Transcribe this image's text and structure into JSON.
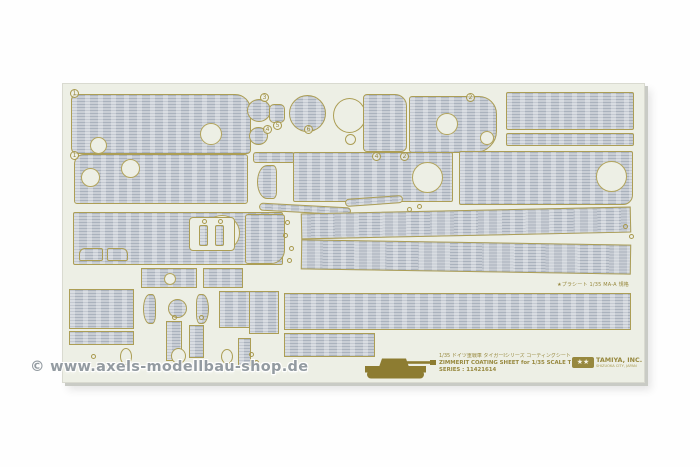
{
  "photo": {
    "background": "#fefefe"
  },
  "colors": {
    "sheet_cream": "#edefe5",
    "zimmerit_fill": "#c2c8cf",
    "zimmerit_rib": "#aab2bd",
    "outline_gold": "#ac9e55",
    "print_gold": "#97883e",
    "watermark_gray": "#8f979e"
  },
  "watermark": {
    "text": "© www.axels-modellbau-shop.de"
  },
  "footer": {
    "jp_line": "1/35 ドイツ重戦車 タイガーⅠシリーズ コーティングシートセット",
    "en_line": "ZIMMERIT COATING SHEET for 1/35 SCALE TIGER I",
    "series_line": "SERIES : 11421614",
    "tiny_note": "★プラシート 1/35 MA-A 規格"
  },
  "logo": {
    "stars": "★★",
    "name": "TAMIYA, INC.",
    "sub": "SHIZUOKA CITY, JAPAN"
  },
  "sheet": {
    "markers": [
      {
        "label": "1",
        "x": 7,
        "y": 5
      },
      {
        "label": "3",
        "x": 197,
        "y": 9
      },
      {
        "label": "4",
        "x": 200,
        "y": 41
      },
      {
        "label": "5",
        "x": 210,
        "y": 37
      },
      {
        "label": "6",
        "x": 241,
        "y": 41
      },
      {
        "label": "2",
        "x": 403,
        "y": 9
      },
      {
        "label": "1",
        "x": 7,
        "y": 67
      },
      {
        "label": "4",
        "x": 309,
        "y": 68
      },
      {
        "label": "2",
        "x": 337,
        "y": 68
      }
    ],
    "dots": [
      [
        222,
        136
      ],
      [
        220,
        149
      ],
      [
        226,
        162
      ],
      [
        224,
        174
      ],
      [
        560,
        140
      ],
      [
        566,
        150
      ],
      [
        28,
        270
      ],
      [
        34,
        278
      ],
      [
        139,
        135
      ],
      [
        155,
        135
      ],
      [
        186,
        268
      ],
      [
        191,
        276
      ],
      [
        109,
        231
      ],
      [
        136,
        231
      ],
      [
        344,
        123
      ],
      [
        354,
        120
      ]
    ],
    "pieces": [
      {
        "t": "p",
        "name": "panel-fender-top-left",
        "x": 8,
        "y": 10,
        "w": 180,
        "h": 60,
        "r": "6px 16px 4px 6px",
        "holes": [
          [
            18,
            42,
            17
          ],
          [
            128,
            28,
            22
          ]
        ]
      },
      {
        "t": "p",
        "name": "disc-small-a",
        "x": 184,
        "y": 15,
        "w": 24,
        "h": 23,
        "r": "50%"
      },
      {
        "t": "p",
        "name": "disc-small-b",
        "x": 186,
        "y": 43,
        "w": 19,
        "h": 18,
        "r": "50%"
      },
      {
        "t": "p",
        "name": "hatch-small",
        "x": 206,
        "y": 20,
        "w": 16,
        "h": 19,
        "r": "5px"
      },
      {
        "t": "p",
        "name": "disc-large",
        "x": 226,
        "y": 11,
        "w": 37,
        "h": 37,
        "r": "50%"
      },
      {
        "t": "o",
        "name": "ring-template",
        "x": 270,
        "y": 14,
        "w": 33,
        "h": 35,
        "r": "50%"
      },
      {
        "t": "o",
        "name": "ring-template-small",
        "x": 282,
        "y": 50,
        "w": 11,
        "h": 11,
        "r": "50%"
      },
      {
        "t": "p",
        "name": "panel-top-mid",
        "x": 300,
        "y": 10,
        "w": 44,
        "h": 58,
        "r": "4px 12px 6px 4px"
      },
      {
        "t": "p",
        "name": "panel-top-holes",
        "x": 346,
        "y": 12,
        "w": 88,
        "h": 57,
        "r": "3px 18px 22px 3px",
        "holes": [
          [
            26,
            16,
            22
          ],
          [
            70,
            34,
            14
          ]
        ]
      },
      {
        "t": "p",
        "name": "panel-top-right-wide",
        "x": 443,
        "y": 8,
        "w": 128,
        "h": 38,
        "r": "2px"
      },
      {
        "t": "p",
        "name": "strip-top-right",
        "x": 443,
        "y": 49,
        "w": 128,
        "h": 13,
        "r": "2px"
      },
      {
        "t": "p",
        "name": "panel-row2-left",
        "x": 11,
        "y": 70,
        "w": 174,
        "h": 50,
        "r": "10px 3px 3px 3px",
        "holes": [
          [
            6,
            13,
            19
          ],
          [
            46,
            4,
            19
          ]
        ]
      },
      {
        "t": "p",
        "name": "bracket-strip",
        "x": 190,
        "y": 68,
        "w": 42,
        "h": 11,
        "r": "3px"
      },
      {
        "t": "p",
        "name": "curved-piece",
        "x": 194,
        "y": 81,
        "w": 20,
        "h": 34,
        "r": "50% 20% 20% 50%"
      },
      {
        "t": "p",
        "name": "panel-row2-mid",
        "x": 230,
        "y": 68,
        "w": 160,
        "h": 50,
        "r": "2px",
        "holes": [
          [
            118,
            9,
            31
          ]
        ]
      },
      {
        "t": "p",
        "name": "panel-row2-right",
        "x": 396,
        "y": 67,
        "w": 174,
        "h": 54,
        "r": "2px 2px 10px 2px",
        "holes": [
          [
            136,
            9,
            31
          ]
        ]
      },
      {
        "t": "p",
        "name": "rod-piece-a",
        "x": 196,
        "y": 121,
        "w": 92,
        "h": 8,
        "r": "4px",
        "rot": 3
      },
      {
        "t": "p",
        "name": "rod-piece-b",
        "x": 282,
        "y": 113,
        "w": 58,
        "h": 8,
        "r": "4px",
        "rot": -4
      },
      {
        "t": "p",
        "name": "panel-row3-left",
        "x": 10,
        "y": 128,
        "w": 210,
        "h": 53,
        "r": "2px",
        "holes": [
          [
            130,
            2,
            36
          ]
        ]
      },
      {
        "t": "o",
        "name": "slot-plate",
        "x": 126,
        "y": 133,
        "w": 46,
        "h": 34,
        "r": "4px"
      },
      {
        "t": "p",
        "name": "slot-bar-a",
        "x": 136,
        "y": 141,
        "w": 9,
        "h": 21,
        "r": "2px"
      },
      {
        "t": "p",
        "name": "slot-bar-b",
        "x": 152,
        "y": 141,
        "w": 9,
        "h": 21,
        "r": "2px"
      },
      {
        "t": "p",
        "name": "panel-row3-mid",
        "x": 182,
        "y": 130,
        "w": 40,
        "h": 50,
        "r": "3px 3px 14px 3px"
      },
      {
        "t": "p",
        "name": "hull-strip-taper-1",
        "x": 238,
        "y": 126,
        "w": 330,
        "h": 26,
        "rot": -1.2
      },
      {
        "t": "p",
        "name": "hull-strip-taper-2",
        "x": 238,
        "y": 158,
        "w": 330,
        "h": 30,
        "rot": 0.9
      },
      {
        "t": "p",
        "name": "hull-strip-wide",
        "x": 221,
        "y": 209,
        "w": 347,
        "h": 37
      },
      {
        "t": "p",
        "name": "hull-strip-short",
        "x": 221,
        "y": 249,
        "w": 91,
        "h": 24
      },
      {
        "t": "p",
        "name": "panel-bottom-left",
        "x": 6,
        "y": 205,
        "w": 65,
        "h": 40
      },
      {
        "t": "p",
        "name": "strip-bottom-left",
        "x": 6,
        "y": 247,
        "w": 65,
        "h": 14
      },
      {
        "t": "p",
        "name": "crescent-left",
        "x": 80,
        "y": 210,
        "w": 13,
        "h": 30,
        "r": "50% 30% 30% 50%"
      },
      {
        "t": "p",
        "name": "disc-bottom",
        "x": 105,
        "y": 215,
        "w": 19,
        "h": 19,
        "r": "50%"
      },
      {
        "t": "p",
        "name": "crescent-right",
        "x": 133,
        "y": 210,
        "w": 13,
        "h": 30,
        "r": "30% 50% 50% 30%"
      },
      {
        "t": "p",
        "name": "block-bottom-a",
        "x": 156,
        "y": 207,
        "w": 31,
        "h": 37
      },
      {
        "t": "p",
        "name": "block-bottom-b",
        "x": 186,
        "y": 207,
        "w": 30,
        "h": 43
      },
      {
        "t": "p",
        "name": "bar-vertical-a",
        "x": 103,
        "y": 237,
        "w": 16,
        "h": 40
      },
      {
        "t": "p",
        "name": "bar-vertical-b",
        "x": 126,
        "y": 241,
        "w": 15,
        "h": 33
      },
      {
        "t": "o",
        "name": "oval-template-a",
        "x": 57,
        "y": 264,
        "w": 12,
        "h": 17,
        "r": "50%"
      },
      {
        "t": "o",
        "name": "circle-template",
        "x": 108,
        "y": 264,
        "w": 15,
        "h": 16,
        "r": "50%"
      },
      {
        "t": "o",
        "name": "oval-template-b",
        "x": 158,
        "y": 265,
        "w": 12,
        "h": 15,
        "r": "50%"
      },
      {
        "t": "p",
        "name": "tab-bottom",
        "x": 175,
        "y": 254,
        "w": 13,
        "h": 28
      },
      {
        "t": "p",
        "name": "bracket-a",
        "x": 16,
        "y": 164,
        "w": 24,
        "h": 13,
        "r": "6px 2px 2px 2px"
      },
      {
        "t": "p",
        "name": "bracket-b",
        "x": 44,
        "y": 164,
        "w": 21,
        "h": 13,
        "r": "2px 6px 2px 2px"
      },
      {
        "t": "p",
        "name": "panel-mid-small-a",
        "x": 78,
        "y": 184,
        "w": 56,
        "h": 20,
        "holes": [
          [
            22,
            4,
            12
          ]
        ]
      },
      {
        "t": "p",
        "name": "panel-mid-small-b",
        "x": 140,
        "y": 184,
        "w": 40,
        "h": 20
      }
    ]
  }
}
